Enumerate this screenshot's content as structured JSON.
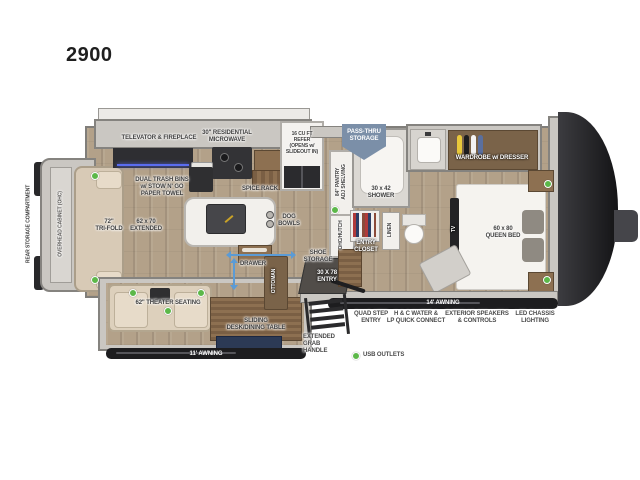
{
  "title": "2900",
  "colors": {
    "usb_green": "#5cb849",
    "passthru_blue": "#7b8fa8",
    "arrow_blue": "#5b9bd5",
    "floor_wood": "#b3a189"
  },
  "legend": {
    "usb": "USB OUTLETS"
  },
  "labels": {
    "rear_storage": "REAR STORAGE COMPARTMENT",
    "ohc_left": "OVERHEAD CABINET (OHC)",
    "trifold": "72\"\nTRI-FOLD",
    "extended": "62 x 70\nEXTENDED",
    "televator": "TELEVATOR & FIREPLACE",
    "microwave": "30\" RESIDENTIAL\nMICROWAVE",
    "trash": "DUAL TRASH BINS\nw/ STOW N' GO\nPAPER TOWEL",
    "spice": "SPICE RACK",
    "refer": "16 CU FT\nREFER\n(OPENS w/\nSLIDEOUT IN)",
    "passthru": "PASS-THRU\nSTORAGE",
    "pantry": "84\" PANTRY\nADJ SHELVING",
    "ohc_hutch": "OHC/HUTCH",
    "shower": "30 x 42\nSHOWER",
    "linen": "LINEN",
    "entry_closet": "ENTRY\nCLOSET",
    "shoe": "SHOE\nSTORAGE",
    "entry_door": "30 X 78\nENTRY",
    "wardrobe": "WARDROBE w/ DRESSER",
    "queen": "60 x 80\nQUEEN BED",
    "tv": "TV",
    "dog_bowls": "DOG\nBOWLS",
    "drawer": "DRAWER",
    "ottoman": "OTTOMAN",
    "theater": "62\" THEATER SEATING",
    "sliding_desk": "SLIDING\nDESK/DINING TABLE",
    "awning11": "11' AWNING",
    "awning14": "14' AWNING",
    "quad_step": "QUAD STEP\nENTRY",
    "hc_water": "H & C WATER &\nLP QUICK CONNECT",
    "ext_speakers": "EXTERIOR SPEAKERS\n& CONTROLS",
    "led_chassis": "LED CHASSIS\nLIGHTING",
    "grab_handle": "EXTENDED\nGRAB\nHANDLE"
  }
}
